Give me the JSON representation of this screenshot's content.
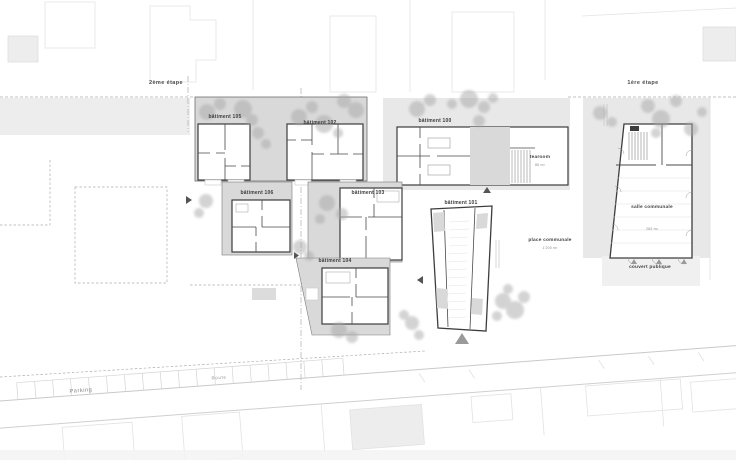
{
  "stages": {
    "second": "2ème étape",
    "first": "1ère étape"
  },
  "buildings": {
    "b105": "bâtiment 105",
    "b102": "bâtiment 102",
    "b100": "bâtiment 100",
    "b106": "bâtiment 106",
    "b103": "bâtiment 103",
    "b104": "bâtiment 104",
    "b101": "bâtiment 101"
  },
  "amenities": {
    "tearoom_label": "tearoom",
    "tearoom_area": "86 m²",
    "salle_label": "salle communale",
    "salle_area": "263 m²",
    "place_label": "place communale",
    "place_area": "1'200 m²",
    "couvert_label": "couvert publique"
  },
  "circulation": {
    "parking": "Parking",
    "route": "Route"
  },
  "colors": {
    "site_zone": "#e9e9e9",
    "roof": "#d9d9d9",
    "wall": "#3d3d3d",
    "tree": "#a8a8a8",
    "faint": "#e3e3e3"
  }
}
